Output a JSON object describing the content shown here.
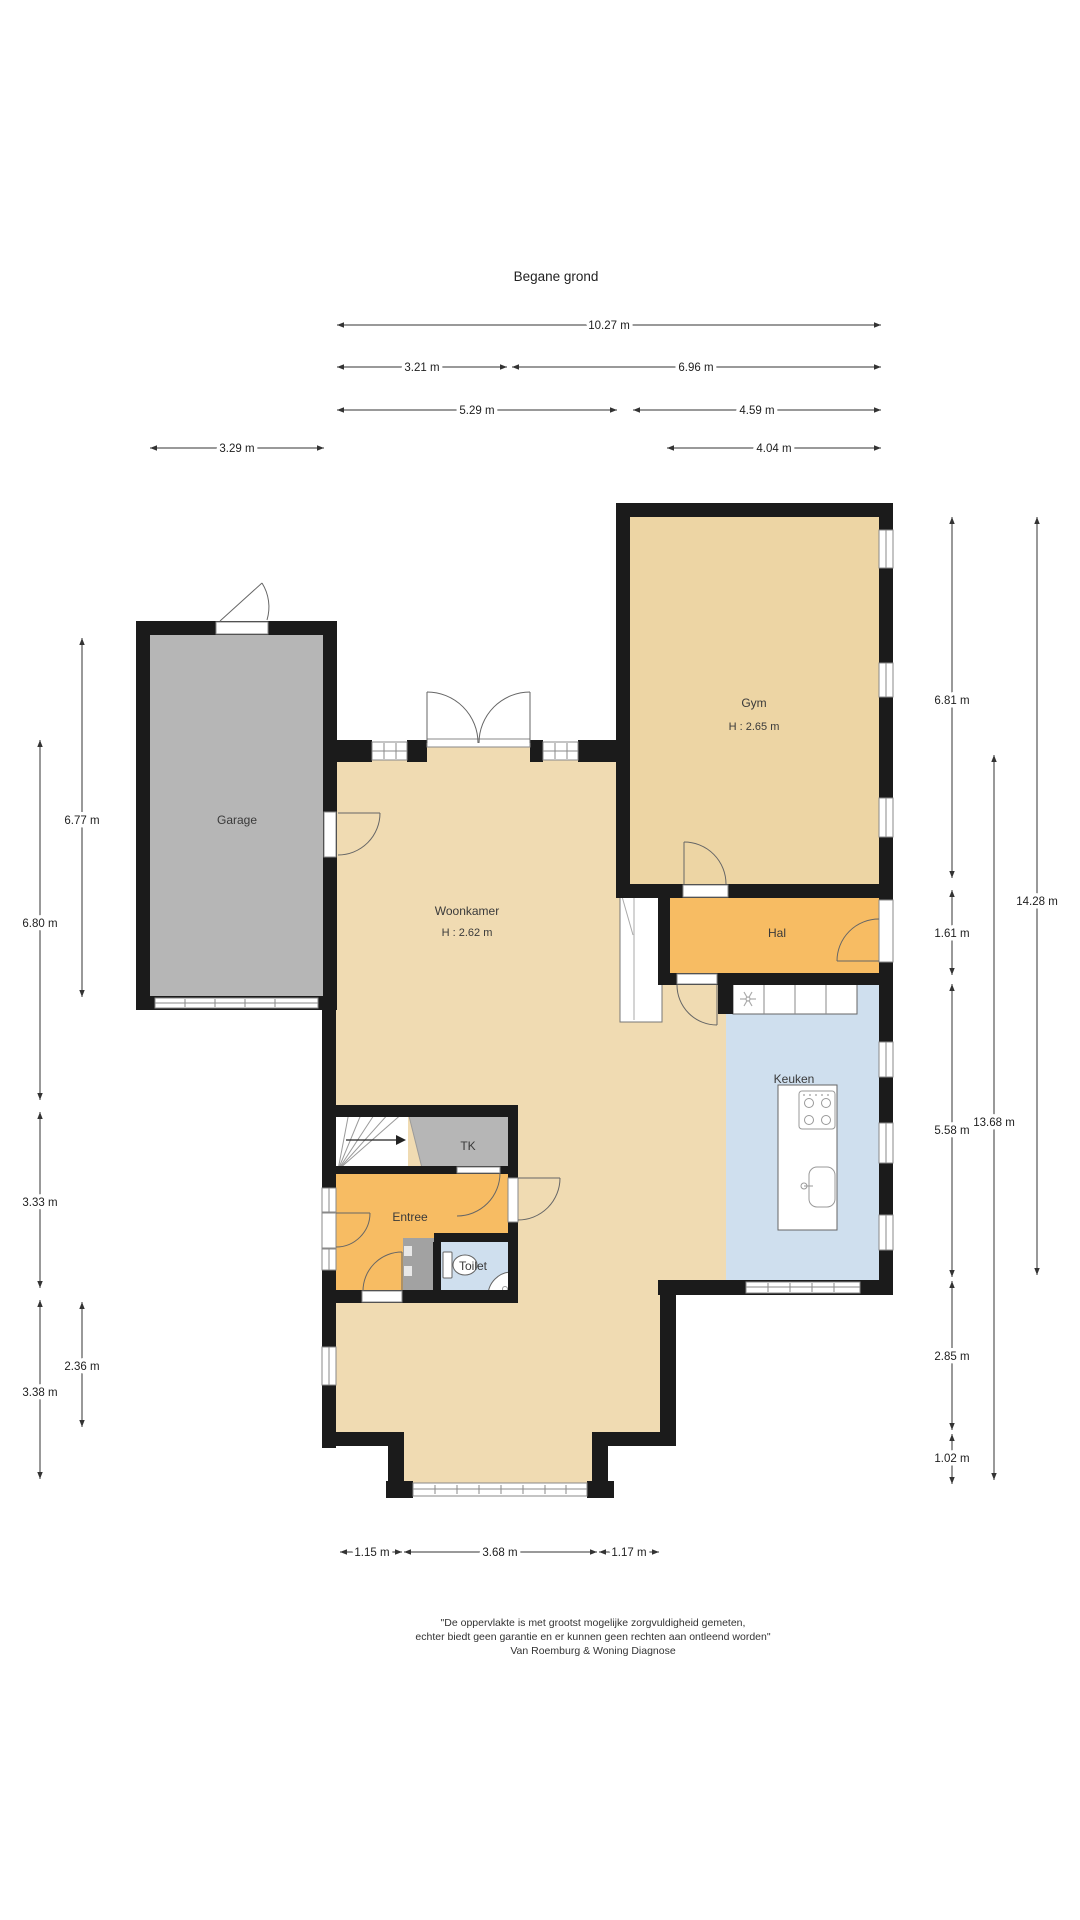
{
  "title": "Begane grond",
  "rooms": {
    "garage": {
      "label": "Garage"
    },
    "gym": {
      "label": "Gym",
      "height": "H : 2.65 m"
    },
    "woonkamer": {
      "label": "Woonkamer",
      "height": "H : 2.62 m"
    },
    "hal": {
      "label": "Hal"
    },
    "keuken": {
      "label": "Keuken"
    },
    "tk": {
      "label": "TK"
    },
    "entree": {
      "label": "Entree"
    },
    "toilet": {
      "label": "Toilet"
    }
  },
  "dimensions": {
    "top_total": "10.27 m",
    "top_row2_left": "3.21 m",
    "top_row2_right": "6.96 m",
    "top_row3_left": "5.29 m",
    "top_row3_right": "4.59 m",
    "top_garage": "3.29 m",
    "top_keuken": "4.04 m",
    "left_garage": "6.77 m",
    "left_upper": "6.80 m",
    "left_mid": "3.33 m",
    "left_lower": "3.38 m",
    "left_inner": "2.36 m",
    "right_gym": "6.81 m",
    "right_hal": "1.61 m",
    "right_keuken": "5.58 m",
    "right_lower": "2.85 m",
    "right_bay": "1.02 m",
    "right_inner_total": "13.68 m",
    "right_outer_total": "14.28 m",
    "bottom_left": "1.15 m",
    "bottom_mid": "3.68 m",
    "bottom_right": "1.17 m"
  },
  "disclaimer": [
    "\"De oppervlakte is met grootst mogelijke zorgvuldigheid gemeten,",
    "echter biedt geen garantie en er kunnen geen rechten aan ontleend worden\"",
    "Van Roemburg & Woning Diagnose"
  ],
  "colors": {
    "wall": "#1b1b1b",
    "floor_living": "#f0dbb2",
    "floor_gym": "#edd5a4",
    "floor_orange": "#f7bc63",
    "floor_gray": "#b6b6b6",
    "floor_gray_dark": "#a2a2a2",
    "floor_blue": "#cfdfee",
    "dimension": "#333333"
  }
}
